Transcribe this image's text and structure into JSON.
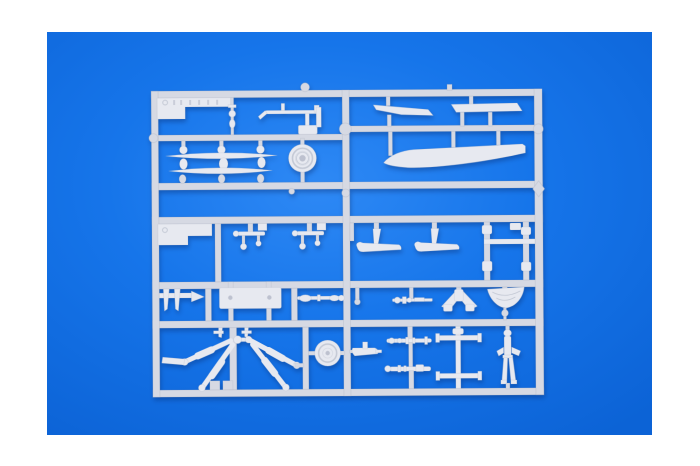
{
  "scene": {
    "kind": "product-photo",
    "subject": "model-kit-sprue",
    "description": "Light grey injection-moulded plastic model kit sprue (frame with helicopter parts: rotor blades, wheels, fuselage fairing, landing gear struts, rockets, gunner figure) photographed flat on a bright blue backdrop with a white photo border"
  },
  "colors": {
    "frame-white": "#ffffff",
    "backdrop": "#1675ea",
    "backdrop-light": "#2e89f5",
    "backdrop-dark": "#0c63d6",
    "plastic": "#d6d9e3",
    "plastic-light": "#e7e9f0",
    "plastic-dark": "#b9bdca",
    "plastic-deep": "#9aa1b4",
    "shadow": "rgba(8,42,110,0.40)"
  },
  "parts": [
    {
      "id": "marking-plate",
      "label": "embossed marking plate"
    },
    {
      "id": "chain-links",
      "label": "small linked beads part"
    },
    {
      "id": "rotor-control-arm",
      "label": "rotor control arm assembly"
    },
    {
      "id": "stabilizer-blades",
      "label": "two slender stabilizer blades with knobs"
    },
    {
      "id": "wheel-large",
      "label": "large main wheel"
    },
    {
      "id": "fin-blades",
      "label": "two angled fin blades"
    },
    {
      "id": "fuselage-fairing",
      "label": "long tapered fuselage fairing"
    },
    {
      "id": "stepped-plate",
      "label": "stepped rectangular plate"
    },
    {
      "id": "control-linkages",
      "label": "two control linkage parts"
    },
    {
      "id": "skid-fairings",
      "label": "two curved skid fairings"
    },
    {
      "id": "mast-frame",
      "label": "two strut columns with cross rung"
    },
    {
      "id": "fork-bracket",
      "label": "forked bracket with arrow tip"
    },
    {
      "id": "hatch-plate",
      "label": "small rectangular hatch plate"
    },
    {
      "id": "drive-shaft",
      "label": "drive shaft rod"
    },
    {
      "id": "machine-gun",
      "label": "small machine gun"
    },
    {
      "id": "gun-mount",
      "label": "angled gun mount"
    },
    {
      "id": "intake-funnel",
      "label": "funnel shaped intake"
    },
    {
      "id": "landing-gear",
      "label": "fanned landing gear struts"
    },
    {
      "id": "wheel-small",
      "label": "small tail wheel"
    },
    {
      "id": "float",
      "label": "small float body"
    },
    {
      "id": "rocket-pods",
      "label": "two rocket / gun pods"
    },
    {
      "id": "axle-crossbar",
      "label": "axle with two crossbars"
    },
    {
      "id": "gunner-figure",
      "label": "standing gunner figure"
    }
  ]
}
